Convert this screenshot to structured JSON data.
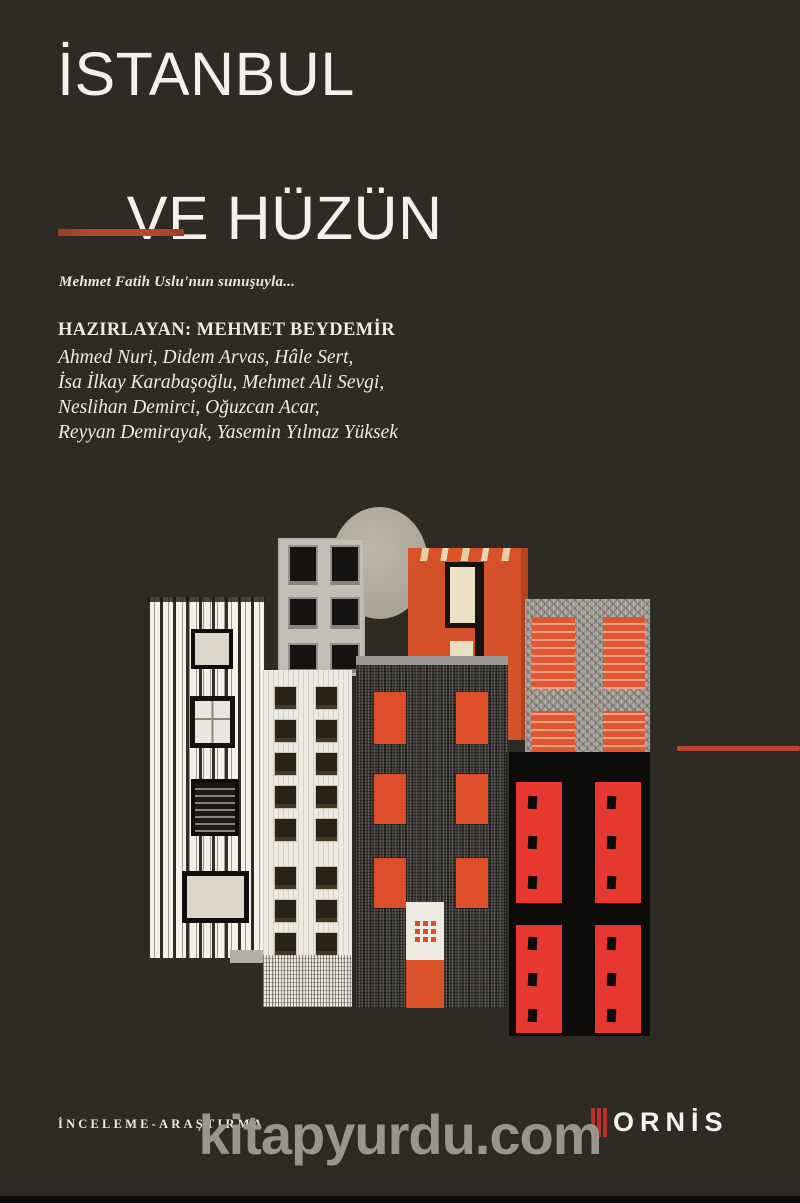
{
  "cover": {
    "title": {
      "line1": "İSTANBUL",
      "line2": "VE HÜZÜN"
    },
    "presenter_note": "Mehmet Fatih Uslu'nun sunuşuyla...",
    "prepared_by": "HAZIRLAYAN: MEHMET BEYDEMİR",
    "contributors": [
      "Ahmed Nuri, Didem Arvas, Hâle Sert,",
      "İsa İlkay Karabaşoğlu, Mehmet Ali Sevgi,",
      "Neslihan Demirci, Oğuzcan Acar,",
      "Reyyan Demirayak, Yasemin Yılmaz Yüksek"
    ],
    "category": "İNCELEME-ARAŞTIRMA",
    "publisher": "ORNİS",
    "colors": {
      "background": "#2d2b24",
      "rule_red": "#b5492e",
      "thin_line_red": "#c1432d",
      "logo_bar_red": "#b8312c",
      "building_orange": "#d5512a",
      "window_red": "#e6382e"
    }
  },
  "watermark": {
    "text": "kitapyurdu.com"
  }
}
